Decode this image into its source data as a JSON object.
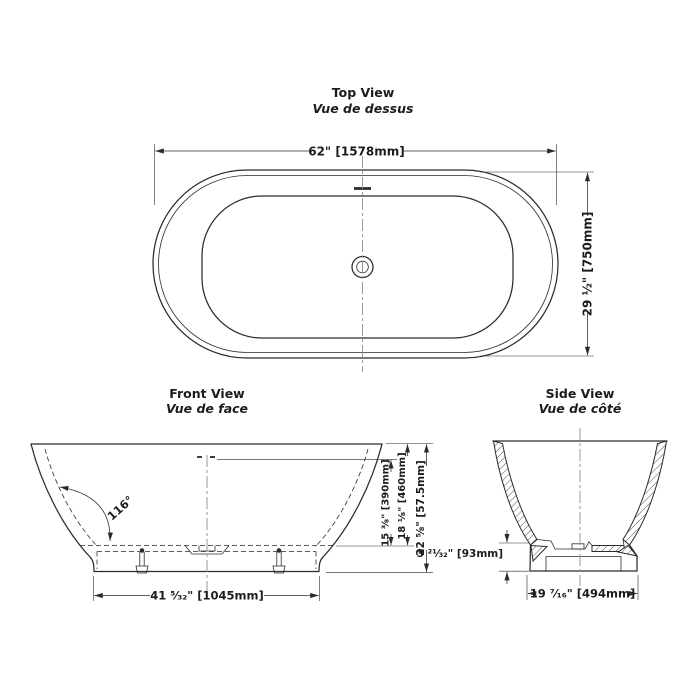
{
  "document": {
    "background": "#ffffff",
    "line_color": "#2b2b2b",
    "centerline_color": "#8f8f8f",
    "text_color": "#1c1c1e"
  },
  "views": {
    "top": {
      "title": "Top View",
      "subtitle": "Vue de dessus",
      "dimensions": {
        "width": "62\" [1578mm]",
        "depth": "29 ½\" [750mm]"
      }
    },
    "front": {
      "title": "Front View",
      "subtitle": "Vue de face",
      "dimensions": {
        "wall_angle": "116°",
        "overflow_height": "15 ⅜\" [390mm]",
        "rim_height": "18 ⅛\" [460mm]",
        "overall_height": "22 ⅝\" [57.5mm]",
        "base_length": "41 ⁵⁄₃₂\" [1045mm]"
      }
    },
    "side": {
      "title": "Side View",
      "subtitle": "Vue de côté",
      "dimensions": {
        "base_height": "3 ²¹⁄₃₂\" [93mm]",
        "base_width": "19 ⁷⁄₁₆\" [494mm]"
      }
    }
  }
}
